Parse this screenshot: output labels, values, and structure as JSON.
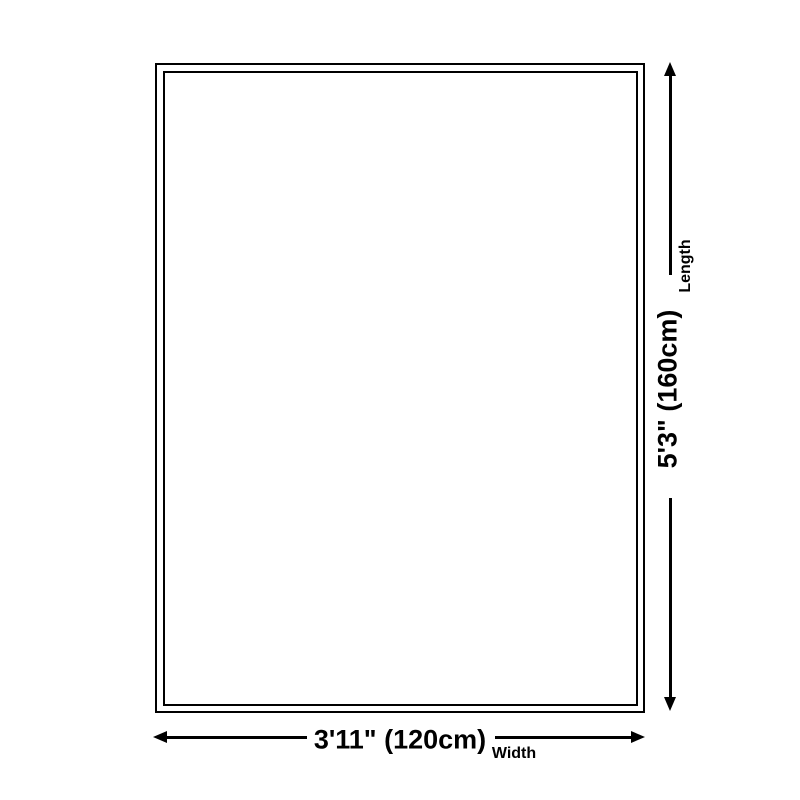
{
  "diagram": {
    "background_color": "#ffffff",
    "line_color": "#000000",
    "rug": {
      "border_color": "#000000",
      "fill_color": "#ffffff"
    },
    "length_dimension": {
      "value": "5'3\" (160cm)",
      "label": "Length"
    },
    "width_dimension": {
      "value": "3'11\" (120cm)",
      "label": "Width"
    }
  }
}
